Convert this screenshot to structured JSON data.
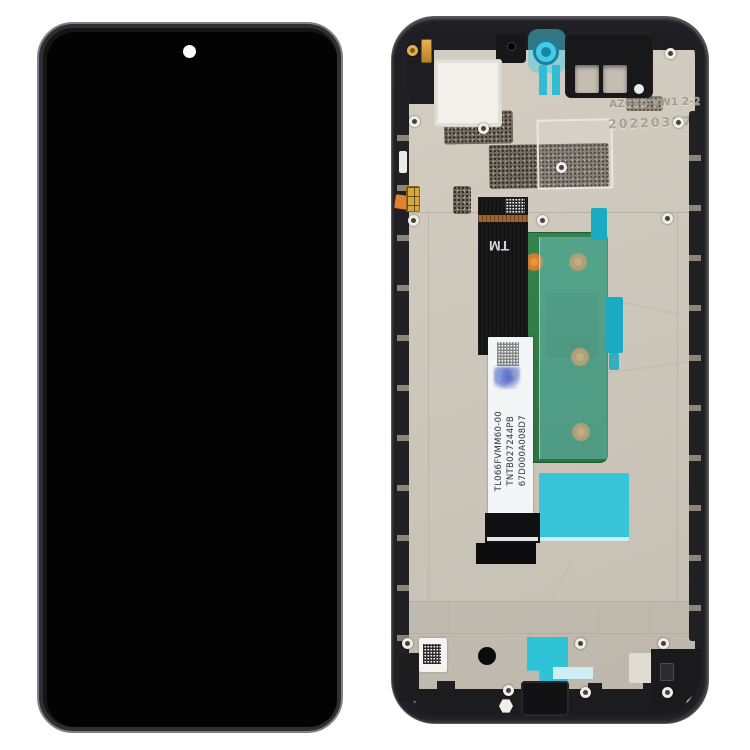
{
  "scene": {
    "background_color": "#ffffff",
    "subject": "Phone LCD screen and digitizer full assembly with frame, front view and back view",
    "front_view": {
      "screen_color": "#030304",
      "frame_edge_color": "#808086",
      "camera_dot_color": "#fafafa"
    },
    "back_view": {
      "frame_color": "#202024",
      "plate_color": "#cbc5ba",
      "etched": {
        "line1": "AZ01D YW1 2-2",
        "line2": "20220327"
      },
      "flex": {
        "tm_mark": "TM",
        "label_lines": [
          "TL066FVMM60-00",
          "TNTB027244PB",
          "67D000A008D7"
        ]
      },
      "colors": {
        "camera_ring": "#45cce2",
        "pcb_green": "#2f7b45",
        "pad_orange": "#e89440",
        "adhesive_cyan": "#38c4d9",
        "copper_band": "#a6622a",
        "gold_contact": "#dba43c"
      }
    }
  }
}
